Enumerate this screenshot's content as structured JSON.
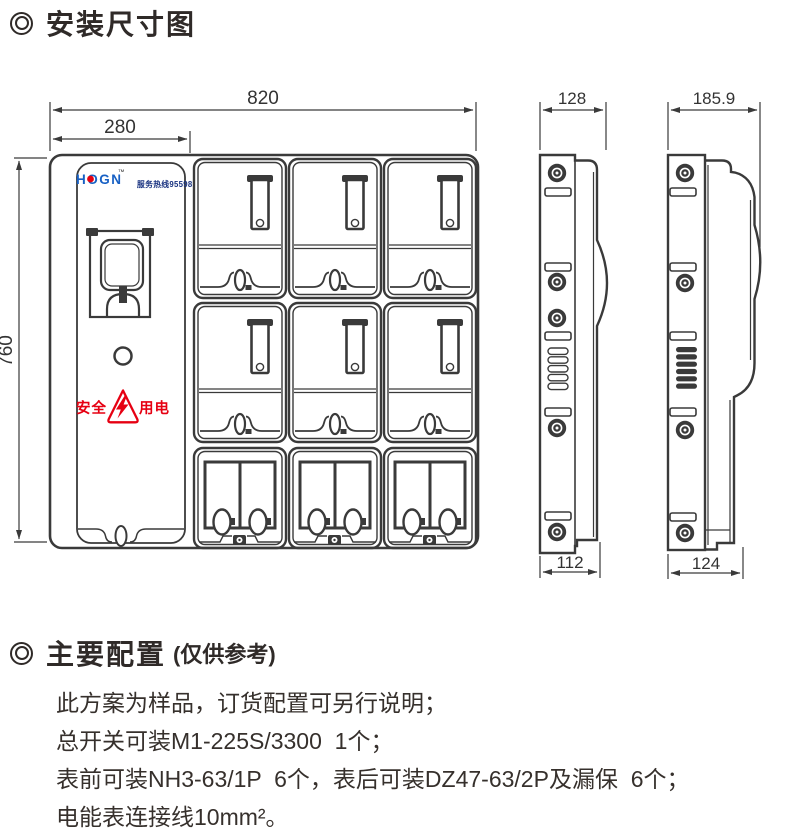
{
  "page": {
    "section1_title": "安装尺寸图",
    "section2_title": "主要配置",
    "section2_subtitle": "(仅供参考)",
    "config_lines": [
      "此方案为样品，订货配置可另行说明；",
      "总开关可装M1-225S/3300  1个；",
      "表前可装NH3-63/1P  6个，表后可装DZ47-63/2P及漏保  6个；",
      "电能表连接线10mm²。"
    ]
  },
  "front_view": {
    "width_label": "820",
    "door_width_label": "280",
    "height_label": "760",
    "logo_text": "HOGN",
    "logo_tm": "™",
    "hotline_text": "服务热线95598",
    "safety_left": "安全",
    "safety_right": "用电"
  },
  "side_view_middle": {
    "top_width_label": "128",
    "bottom_width_label": "112"
  },
  "side_view_right": {
    "top_width_label": "185.9",
    "bottom_width_label": "124"
  },
  "colors": {
    "line": "#3a3a3a",
    "logo_blue": "#1760c4",
    "hotline_blue": "#16307f",
    "safety_red": "#e60012",
    "text_dark": "#2f2a28"
  }
}
